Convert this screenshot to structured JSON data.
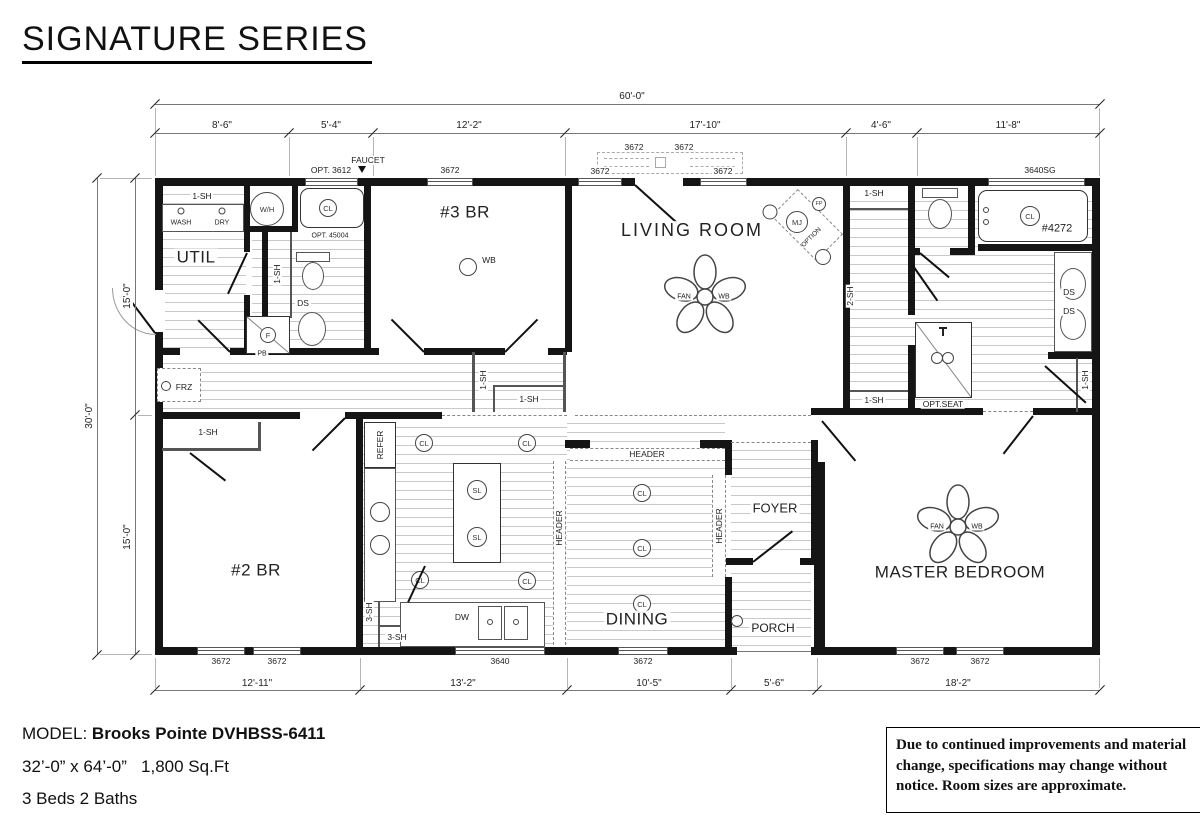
{
  "title": "SIGNATURE SERIES",
  "dims": {
    "overall_w": "60'-0\"",
    "top": [
      "8'-6\"",
      "5'-4\"",
      "12'-2\"",
      "17'-10\"",
      "4'-6\"",
      "11'-8\""
    ],
    "overall_h": "30'-0\"",
    "left": [
      "15'-0\"",
      "15'-0\""
    ],
    "bottom": [
      "12'-11\"",
      "13'-2\"",
      "10'-5\"",
      "5'-6\"",
      "18'-2\""
    ]
  },
  "windows": {
    "w3672": "3672",
    "w3640": "3640",
    "w3640sg": "3640SG",
    "opt3612": "OPT. 3612",
    "faucet": "FAUCET"
  },
  "rooms": {
    "util": "UTIL",
    "br3": "#3 BR",
    "living": "LIVING ROOM",
    "br2": "#2 BR",
    "dining": "DINING",
    "foyer": "FOYER",
    "porch": "PORCH",
    "master": "MASTER BEDROOM"
  },
  "labels": {
    "sh1": "1-SH",
    "sh2": "2-SH",
    "sh3": "3-SH",
    "wash": "WASH",
    "dry": "DRY",
    "wh": "W/H",
    "opt45004": "OPT. 45004",
    "ds": "DS",
    "f": "F",
    "pb": "PB",
    "frz": "FRZ",
    "wb": "WB",
    "fan": "FAN",
    "cl": "CL",
    "sl": "SL",
    "mj": "MJ",
    "fp": "FP",
    "option": "OPTION",
    "tub": "#4272",
    "optseat": "OPT.SEAT",
    "refer": "REFER",
    "dw": "DW",
    "header": "HEADER"
  },
  "footer": {
    "model_prefix": "MODEL:",
    "model_name": "Brooks Pointe DVHBSS-6411",
    "size": "32’-0” x 64’-0”",
    "area": "1,800 Sq.Ft",
    "beds": "3 Beds 2 Baths",
    "disclaimer": "Due to continued improvements and material change, specifications may change without notice. Room sizes are approximate."
  }
}
